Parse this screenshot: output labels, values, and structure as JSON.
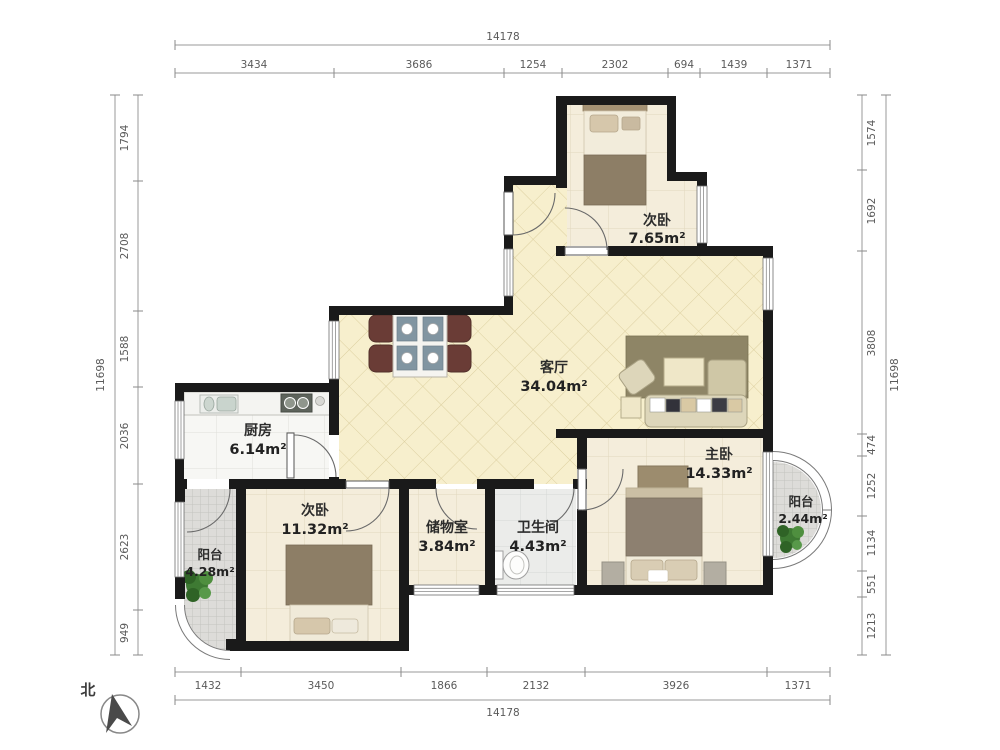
{
  "dims": {
    "top": {
      "total": "14178",
      "segments": [
        "3434",
        "3686",
        "1254",
        "2302",
        "694",
        "1439",
        "1371"
      ]
    },
    "bottom": {
      "total": "14178",
      "segments": [
        "1432",
        "3450",
        "1866",
        "2132",
        "3926",
        "1371"
      ]
    },
    "left": {
      "total": "11698",
      "segments": [
        "1794",
        "2708",
        "1588",
        "2036",
        "2623",
        "949"
      ]
    },
    "right": {
      "total": "11698",
      "segments": [
        "1574",
        "1692",
        "3808",
        "474",
        "1252",
        "1134",
        "551",
        "1213"
      ]
    }
  },
  "rooms": {
    "bedroom_top": {
      "name": "次卧",
      "area": "7.65m²"
    },
    "living": {
      "name": "客厅",
      "area": "34.04m²"
    },
    "kitchen": {
      "name": "厨房",
      "area": "6.14m²"
    },
    "bedroom_left": {
      "name": "次卧",
      "area": "11.32m²"
    },
    "storage": {
      "name": "储物室",
      "area": "3.84m²"
    },
    "bath": {
      "name": "卫生间",
      "area": "4.43m²"
    },
    "master": {
      "name": "主卧",
      "area": "14.33m²"
    },
    "balcony_left": {
      "name": "阳台",
      "area": "4.28m²"
    },
    "balcony_right": {
      "name": "阳台",
      "area": "2.44m²"
    }
  },
  "compass": {
    "label": "北"
  },
  "colors": {
    "wall": "#1a1a1a",
    "living_floor": "#f7efcd",
    "bedroom_floor": "#f4eddb",
    "kitchen_floor": "#f7f7f4",
    "bath_floor": "#ebecea",
    "balcony_floor": "#dddddа",
    "chair": "#6a3c36",
    "rug": "#8e8566",
    "plant": "#3e7a33"
  }
}
